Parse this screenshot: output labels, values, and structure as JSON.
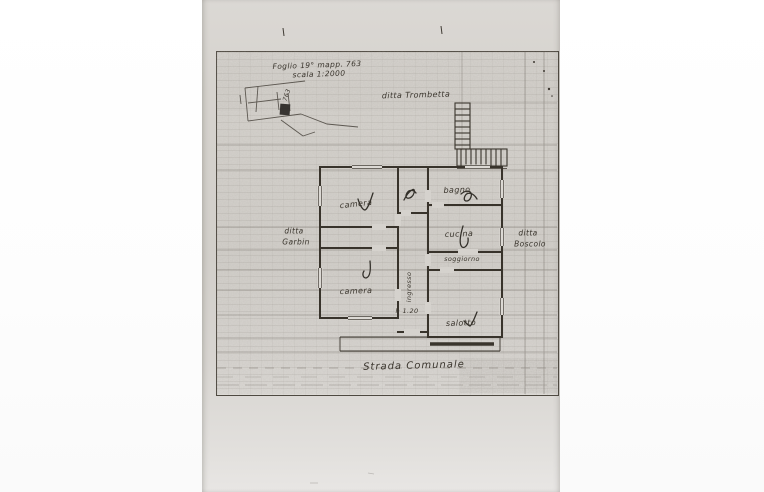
{
  "drawing": {
    "title": {
      "line1": "Foglio 19° mapp. 763",
      "line2": "scala 1:2000"
    },
    "neighbors": {
      "north": "ditta Trombetta",
      "west": {
        "line1": "ditta",
        "line2": "Garbin"
      },
      "east": {
        "line1": "ditta",
        "line2": "Boscolo"
      }
    },
    "rooms": {
      "bedroom_top": "camera",
      "bathroom": "bagno",
      "kitchen": "cucina",
      "living_room": "soggiorno",
      "bedroom_bottom": "camera",
      "hallway": "ingresso",
      "height_note": "h 1.20",
      "sitting_room": "salotto"
    },
    "street": "Strada Comunale",
    "inset": {
      "parcel_number": "763"
    },
    "colors": {
      "paper": "#d5d2cd",
      "ink": "#3a352d",
      "grid": "#5d574f"
    }
  }
}
